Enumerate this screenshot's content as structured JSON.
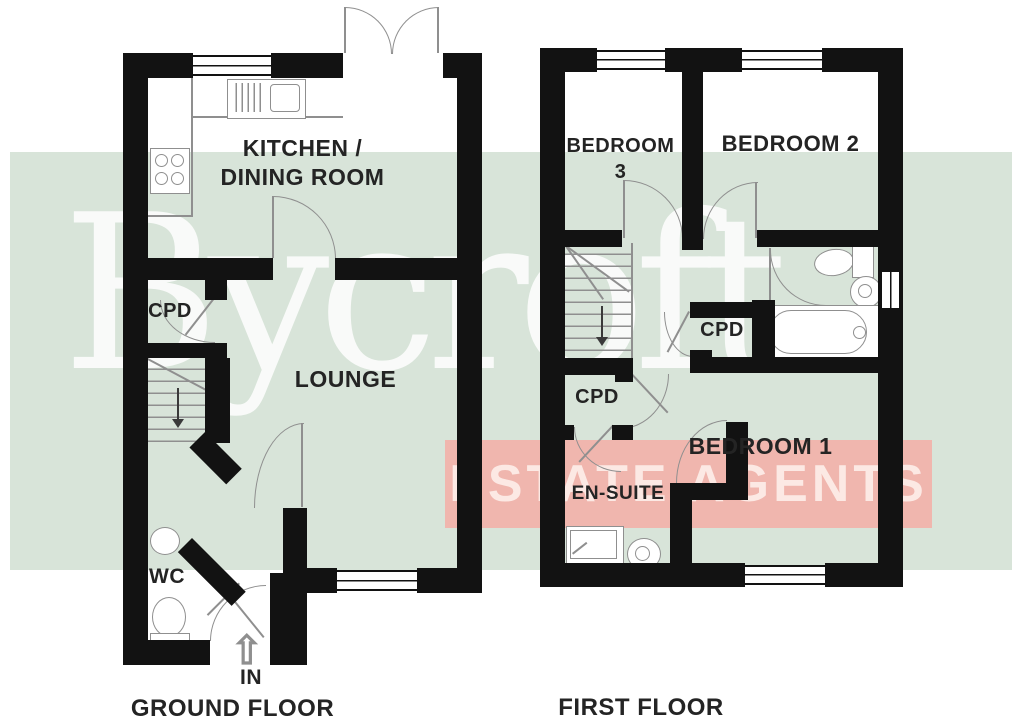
{
  "watermark": {
    "brand": "Bycroft",
    "banner": "ESTATE AGENTS"
  },
  "ground_floor": {
    "title": "GROUND FLOOR",
    "kitchen_line1": "KITCHEN /",
    "kitchen_line2": "DINING ROOM",
    "cpd": "CPD",
    "lounge": "LOUNGE",
    "wc": "WC",
    "entrance": "IN"
  },
  "first_floor": {
    "title": "FIRST FLOOR",
    "bedroom3_line1": "BEDROOM",
    "bedroom3_line2": "3",
    "bedroom2": "BEDROOM 2",
    "cpd_landing": "CPD",
    "cpd_bathroom": "CPD",
    "ensuite": "EN-SUITE",
    "bedroom1": "BEDROOM 1"
  },
  "icons": {
    "entrance_arrow": "⇧"
  },
  "colors": {
    "wall": "#121212",
    "fixture_line": "#8f8f8f",
    "label_text": "#242424",
    "band": "#d8e4d9",
    "banner_bg": "#f0b6ae"
  }
}
